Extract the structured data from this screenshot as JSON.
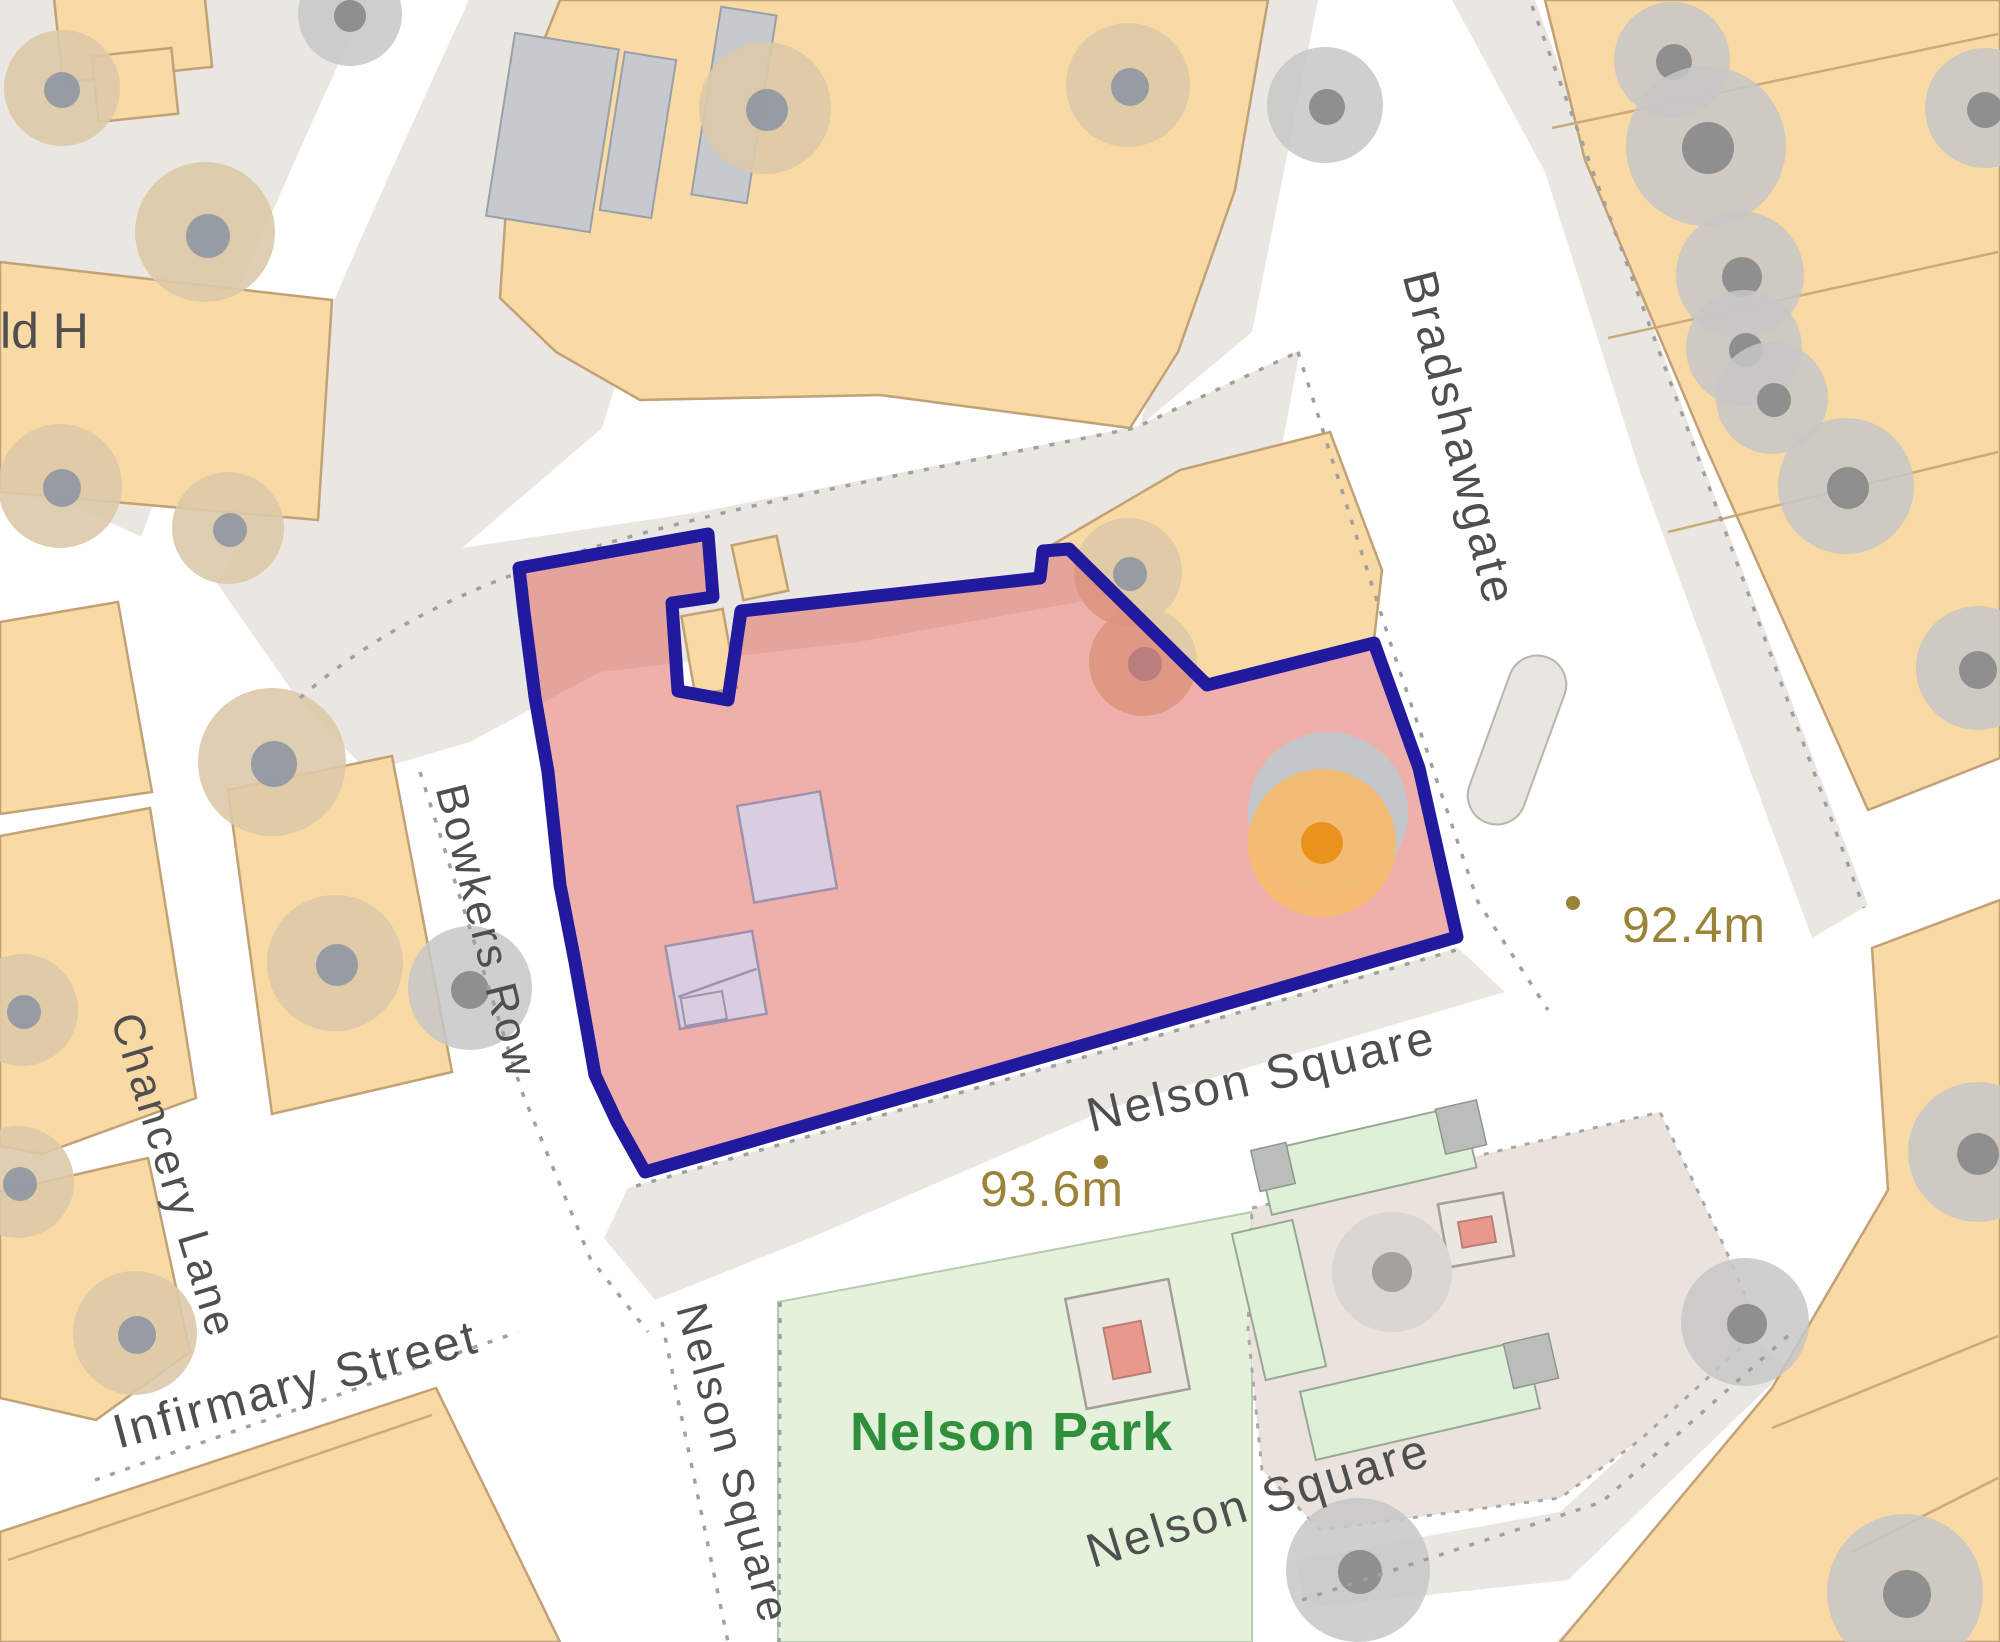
{
  "map": {
    "street_labels": {
      "bradshawgate": "Bradshawgate",
      "bowkers_row": "Bowkers Row",
      "chancery_lane": "Chancery Lane",
      "infirmary_street": "Infirmary Street",
      "nelson_square_upper": "Nelson Square",
      "nelson_square_lower": "Nelson Square",
      "nelson_square_west": "Nelson Square",
      "edge_fragment": "ld H"
    },
    "place_labels": {
      "nelson_park": "Nelson Park"
    },
    "spot_heights": {
      "east": "92.4m",
      "south": "93.6m"
    },
    "colors": {
      "parcel_outline": "#221a9e",
      "parcel_fill": "#dd6155",
      "building_buff": "#f9d9a4",
      "pavement_gray": "#eae7e2",
      "park_green": "#e4f2db",
      "plaza_pink_gray": "#e9e2dd",
      "orange_tree": "#f6bb6e",
      "orange_tree_core": "#e8941c",
      "spot_height_text": "#9b8339",
      "street_text": "#4f4f4f",
      "park_text": "#2f8f3c"
    },
    "icons": [
      "tree-icon",
      "spot-height-dot",
      "fountain-icon",
      "traffic-island"
    ]
  }
}
